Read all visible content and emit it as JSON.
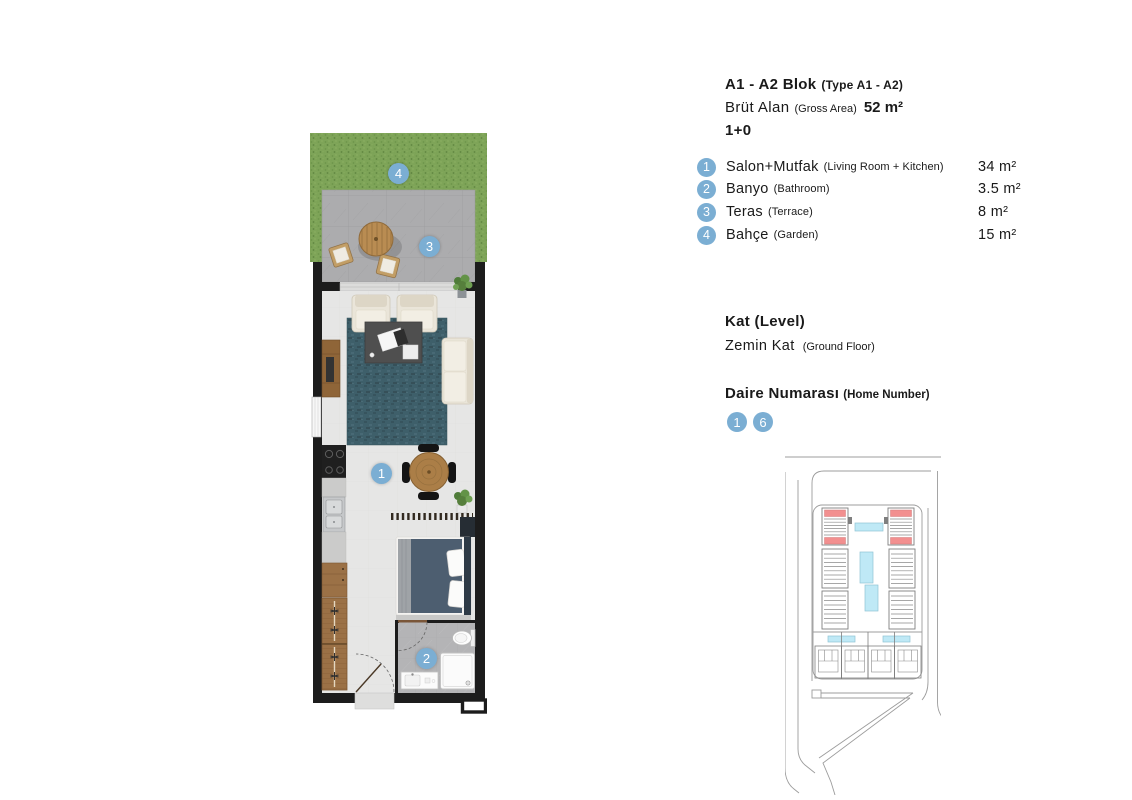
{
  "colors": {
    "badge_blue": "#7baed3",
    "grass_green": "#7ea458",
    "terrace_gray": "#acacae",
    "wall_black": "#1c1c1c",
    "rug_teal": "#3e5f6a",
    "site_unit_red": "#f28f8f",
    "pool_blue": "#bfe9f6"
  },
  "header": {
    "block_title": "A1 - A2 Blok",
    "block_subtitle": "(Type A1 - A2)",
    "gross_area_label": "Brüt Alan",
    "gross_area_sublabel": "(Gross Area)",
    "gross_area_value": "52 m²",
    "room_layout": "1+0"
  },
  "legend": {
    "items": [
      {
        "num": "1",
        "name_tr": "Salon+Mutfak",
        "name_en": "(Living Room + Kitchen)",
        "area": "34 m²"
      },
      {
        "num": "2",
        "name_tr": "Banyo",
        "name_en": "(Bathroom)",
        "area": "3.5 m²"
      },
      {
        "num": "3",
        "name_tr": "Teras",
        "name_en": "(Terrace)",
        "area": "8 m²"
      },
      {
        "num": "4",
        "name_tr": "Bahçe",
        "name_en": "(Garden)",
        "area": "15 m²"
      }
    ]
  },
  "level": {
    "label": "Kat (Level)",
    "value_tr": "Zemin Kat",
    "value_en": "(Ground Floor)"
  },
  "home_number": {
    "label_tr": "Daire Numarası",
    "label_en": "(Home Number)",
    "numbers": [
      "1",
      "6"
    ]
  },
  "floor_plan": {
    "badges": [
      {
        "num": "4",
        "room": "garden"
      },
      {
        "num": "3",
        "room": "terrace"
      },
      {
        "num": "1",
        "room": "living-kitchen"
      },
      {
        "num": "2",
        "room": "bathroom"
      }
    ]
  }
}
